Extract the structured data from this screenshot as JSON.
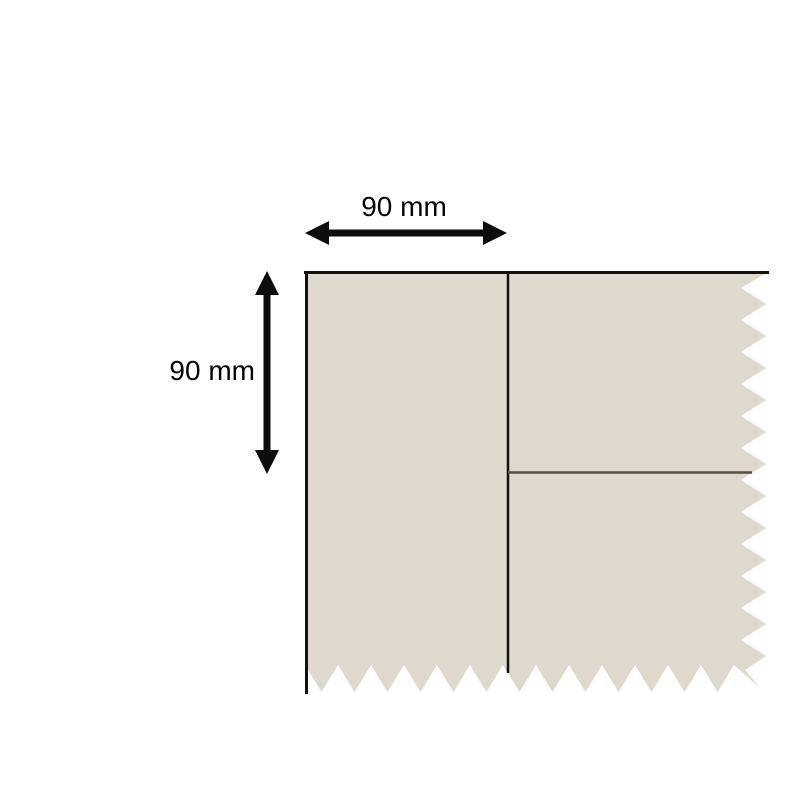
{
  "diagram": {
    "type": "dimensioned-fabric-swatch",
    "dimensions": [
      {
        "id": "width",
        "label": "90 mm",
        "value": 90,
        "unit": "mm",
        "orientation": "horizontal"
      },
      {
        "id": "height",
        "label": "90 mm",
        "value": 90,
        "unit": "mm",
        "orientation": "vertical"
      }
    ],
    "colors": {
      "background": "#ffffff",
      "fabric": "#dfd8cc",
      "outline": "#14100b",
      "divider": "#55503f",
      "dimension": "#0d0d0d"
    }
  }
}
